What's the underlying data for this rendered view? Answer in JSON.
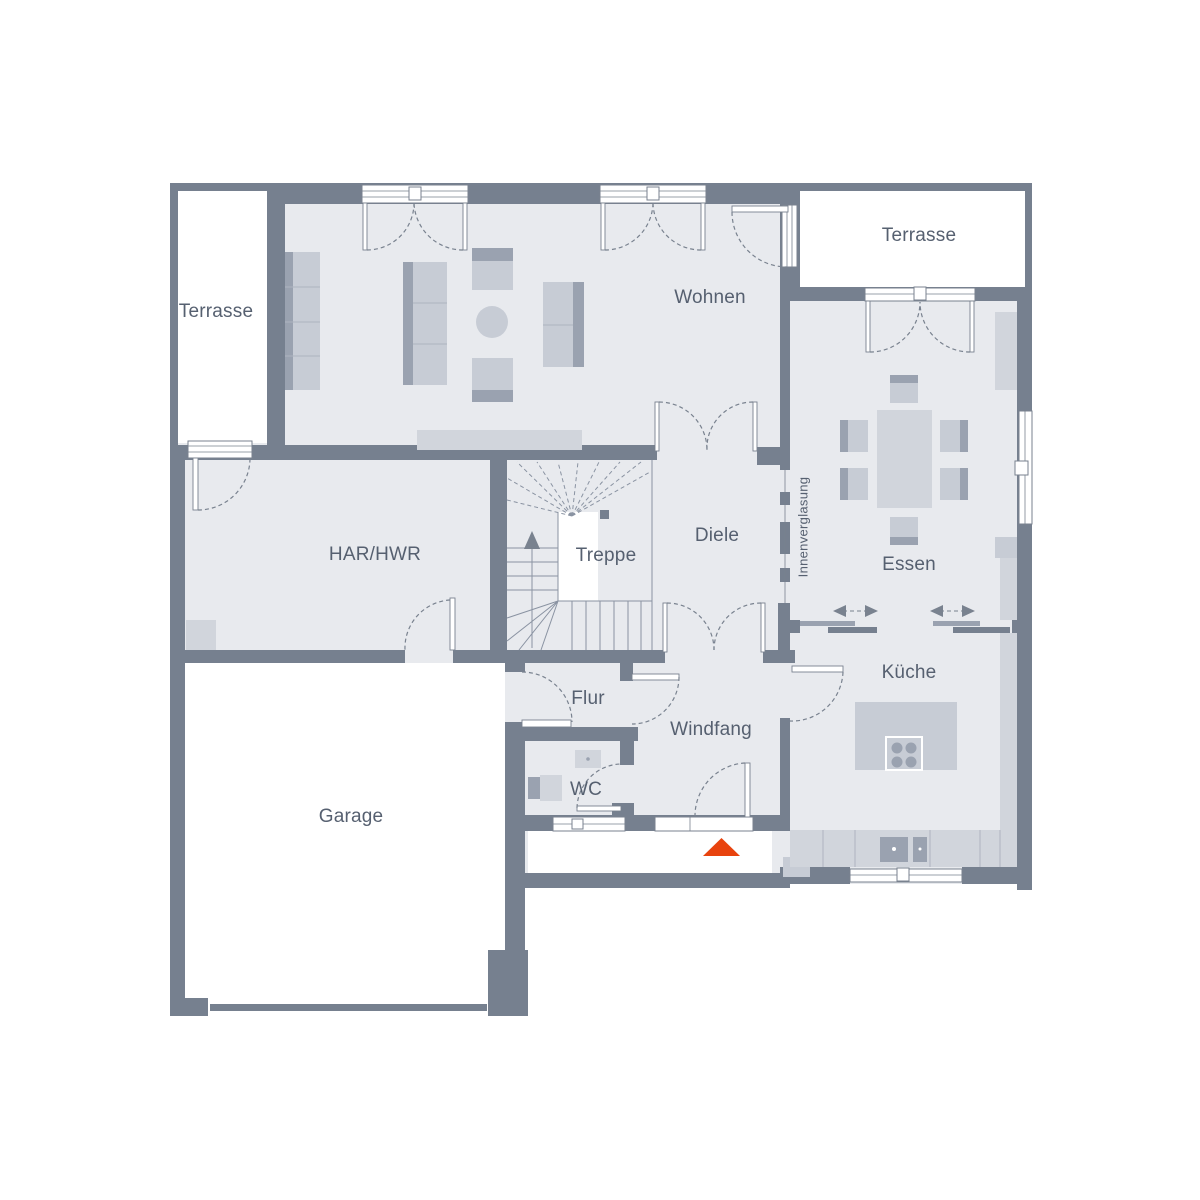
{
  "plan": {
    "type": "floor-plan",
    "labels": {
      "terrasse_left": "Terrasse",
      "terrasse_right": "Terrasse",
      "wohnen": "Wohnen",
      "essen": "Essen",
      "innenverglasung": "Innenverglasung",
      "har_hwr": "HAR/HWR",
      "treppe": "Treppe",
      "diele": "Diele",
      "kueche": "Küche",
      "flur": "Flur",
      "windfang": "Windfang",
      "wc": "WC",
      "garage": "Garage"
    },
    "icons": {
      "entrance_marker": "triangle-up"
    },
    "colors": {
      "wall": "#76808F",
      "floor": "#E8EAEE",
      "outdoor": "#FFFFFF",
      "furn_light": "#D1D5DC",
      "furn_medium": "#C7CCD5",
      "furn_dark": "#9AA2B0",
      "furn_line": "#AEB4C0",
      "door_line": "#79828F",
      "stair_line": "#8A93A2",
      "label_text": "#566070",
      "entrance_accent": "#E8430E"
    }
  }
}
